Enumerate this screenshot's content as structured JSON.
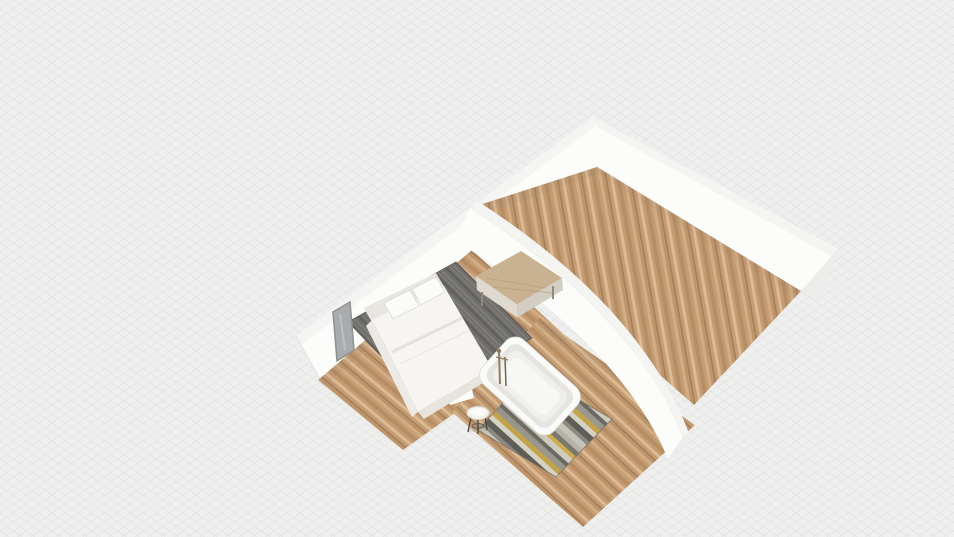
{
  "app": {
    "name": "3D Floor Plan Viewer",
    "view_mode": "3D perspective top view"
  },
  "scene": {
    "colors": {
      "bg": "#efefee",
      "hatch": "#d5d5da",
      "wall_face": "#fcfcfb",
      "wall_top": "#f4f4f2",
      "wall_shade": "#eeeeec",
      "wall_cap": "#ececea",
      "wall_edge": "#e7e7e5",
      "wood_base": "#c49c74",
      "wood_dark": "#b78d63",
      "wood_darker": "#a8815a",
      "wood_light": "#d2ac83",
      "wood_pale": "#dcba92",
      "rug_base": "#6f6e6b",
      "rug_light": "#7e7d79",
      "rug_dark": "#605e5c",
      "rug_mid": "#848279",
      "bathrug_1": "#c6c3b8",
      "bathrug_2": "#8a887f",
      "bathrug_3": "#5f5d57",
      "bathrug_4": "#d6d2c4",
      "bathrug_5": "#c2a24b",
      "bathrug_6": "#9a978c",
      "bathrug_7": "#6b6962",
      "bathrug_8": "#cfcbbd",
      "bathrug_9": "#d0ac4f",
      "bathrug_10": "#7a786f",
      "bathrug_11": "#b5b2a6",
      "bed_body": "#f6f5f2",
      "bed_head": "#e9e6e1",
      "bed_side": "#eceae5",
      "bed_foot": "#e7e4de",
      "pillow": "#fbfbf9",
      "desk_top": "#c8b292",
      "desk_front": "#dfdad1",
      "desk_leg": "#938a77",
      "mirror_glass": "#a9abad",
      "mirror_frame": "#909092",
      "mirror_streak": "#c6c8ca",
      "tub_outer": "#fafaf8",
      "tub_rim": "#e6e4e0",
      "tub_inner": "#f0efec",
      "tub_basin": "#f7f7f5",
      "faucet_a": "#8f7d5e",
      "faucet_b": "#746649",
      "stool_top": "#f3f2ee",
      "stool_leg": "#4c4a47"
    },
    "rooms": [
      {
        "name": "living-room",
        "floor": "wood planks"
      },
      {
        "name": "bedroom",
        "floor": "wood planks"
      },
      {
        "name": "bathroom",
        "floor": "wood planks"
      }
    ],
    "objects": [
      {
        "name": "nw-wall"
      },
      {
        "name": "ne-wall"
      },
      {
        "name": "divider-wall"
      },
      {
        "name": "bathroom-partition-wall"
      },
      {
        "name": "wall-mirror"
      },
      {
        "name": "bedroom-rug"
      },
      {
        "name": "double-bed"
      },
      {
        "name": "desk"
      },
      {
        "name": "bathtub"
      },
      {
        "name": "freestanding-faucet"
      },
      {
        "name": "side-stool"
      },
      {
        "name": "bathroom-rug"
      }
    ]
  }
}
